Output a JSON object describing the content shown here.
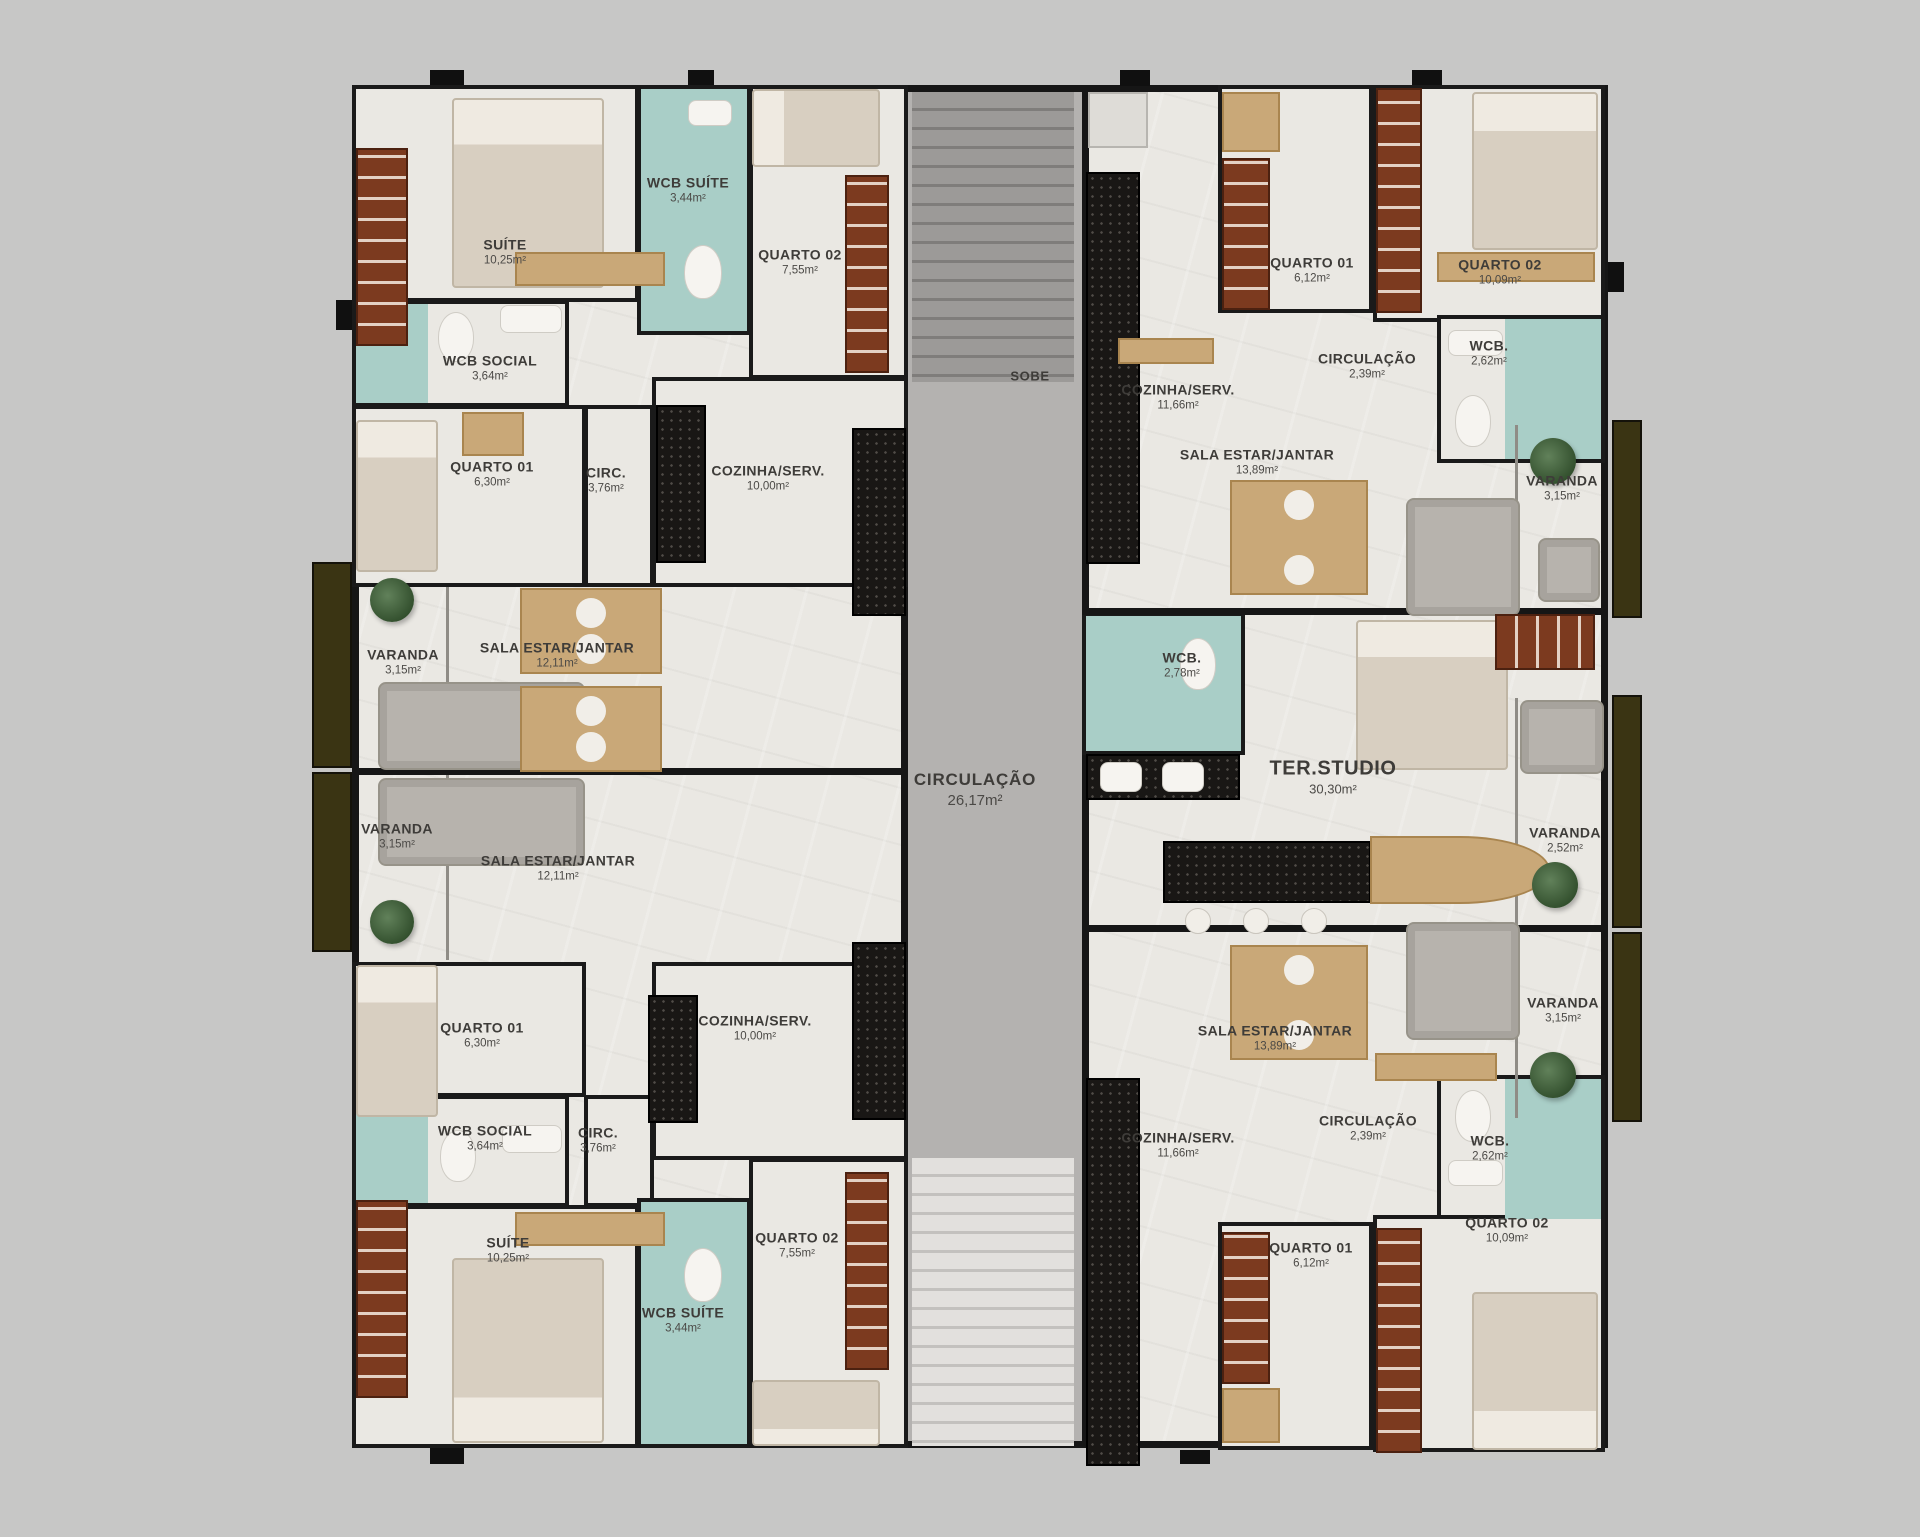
{
  "labels": {
    "sobe": "SOBE"
  },
  "rooms": {
    "suite_tl": {
      "name": "SUÍTE",
      "area": "10,25m²"
    },
    "wcb_suite_tl": {
      "name": "WCB SUÍTE",
      "area": "3,44m²"
    },
    "quarto02_tl": {
      "name": "QUARTO 02",
      "area": "7,55m²"
    },
    "wcb_social_tl": {
      "name": "WCB SOCIAL",
      "area": "3,64m²"
    },
    "quarto01_tl": {
      "name": "QUARTO 01",
      "area": "6,30m²"
    },
    "circ_tl": {
      "name": "CIRC.",
      "area": "3,76m²"
    },
    "cozinha_tl": {
      "name": "COZINHA/SERV.",
      "area": "10,00m²"
    },
    "sala_tl": {
      "name": "SALA ESTAR/JANTAR",
      "area": "12,11m²"
    },
    "varanda_tl": {
      "name": "VARANDA",
      "area": "3,15m²"
    },
    "cozinha_tr": {
      "name": "COZINHA/SERV.",
      "area": "11,66m²"
    },
    "quarto01_tr": {
      "name": "QUARTO 01",
      "area": "6,12m²"
    },
    "quarto02_tr": {
      "name": "QUARTO 02",
      "area": "10,09m²"
    },
    "circulacao_tr": {
      "name": "CIRCULAÇÃO",
      "area": "2,39m²"
    },
    "wcb_tr": {
      "name": "WCB.",
      "area": "2,62m²"
    },
    "sala_tr": {
      "name": "SALA ESTAR/JANTAR",
      "area": "13,89m²"
    },
    "varanda_tr": {
      "name": "VARANDA",
      "area": "3,15m²"
    },
    "circulacao_central": {
      "name": "CIRCULAÇÃO",
      "area": "26,17m²"
    },
    "wcb_studio": {
      "name": "WCB.",
      "area": "2,78m²"
    },
    "ter_studio": {
      "name": "TER.STUDIO",
      "area": "30,30m²"
    },
    "varanda_studio": {
      "name": "VARANDA",
      "area": "2,52m²"
    },
    "varanda_bl": {
      "name": "VARANDA",
      "area": "3,15m²"
    },
    "sala_bl": {
      "name": "SALA ESTAR/JANTAR",
      "area": "12,11m²"
    },
    "quarto01_bl": {
      "name": "QUARTO 01",
      "area": "6,30m²"
    },
    "cozinha_bl": {
      "name": "COZINHA/SERV.",
      "area": "10,00m²"
    },
    "wcb_social_bl": {
      "name": "WCB SOCIAL",
      "area": "3,64m²"
    },
    "circ_bl": {
      "name": "CIRC.",
      "area": "3,76m²"
    },
    "suite_bl": {
      "name": "SUÍTE",
      "area": "10,25m²"
    },
    "wcb_suite_bl": {
      "name": "WCB SUÍTE",
      "area": "3,44m²"
    },
    "quarto02_bl": {
      "name": "QUARTO 02",
      "area": "7,55m²"
    },
    "sala_br": {
      "name": "SALA ESTAR/JANTAR",
      "area": "13,89m²"
    },
    "cozinha_br": {
      "name": "COZINHA/SERV.",
      "area": "11,66m²"
    },
    "circulacao_br": {
      "name": "CIRCULAÇÃO",
      "area": "2,39m²"
    },
    "wcb_br": {
      "name": "WCB.",
      "area": "2,62m²"
    },
    "quarto01_br": {
      "name": "QUARTO 01",
      "area": "6,12m²"
    },
    "quarto02_br": {
      "name": "QUARTO 02",
      "area": "10,09m²"
    },
    "varanda_br": {
      "name": "VARANDA",
      "area": "3,15m²"
    }
  },
  "colors": {
    "background": "#c7c7c6",
    "floor": "#eae8e3",
    "wall": "#161616",
    "bathroom_floor": "#a9cec7",
    "corridor": "#b4b2b0",
    "stairs_dark": "#8e8c8a",
    "stairs_light": "#d7d5d2",
    "wood": "#c9a878",
    "wardrobe_wood": "#7c3a1f",
    "kitchen_counter": "#191715",
    "bed": "#d8cfc1",
    "sofa": "#b7b3ad",
    "plant": "#3f5c38",
    "balcony_planter": "#3a3413",
    "label_text": "#3e3c39"
  }
}
